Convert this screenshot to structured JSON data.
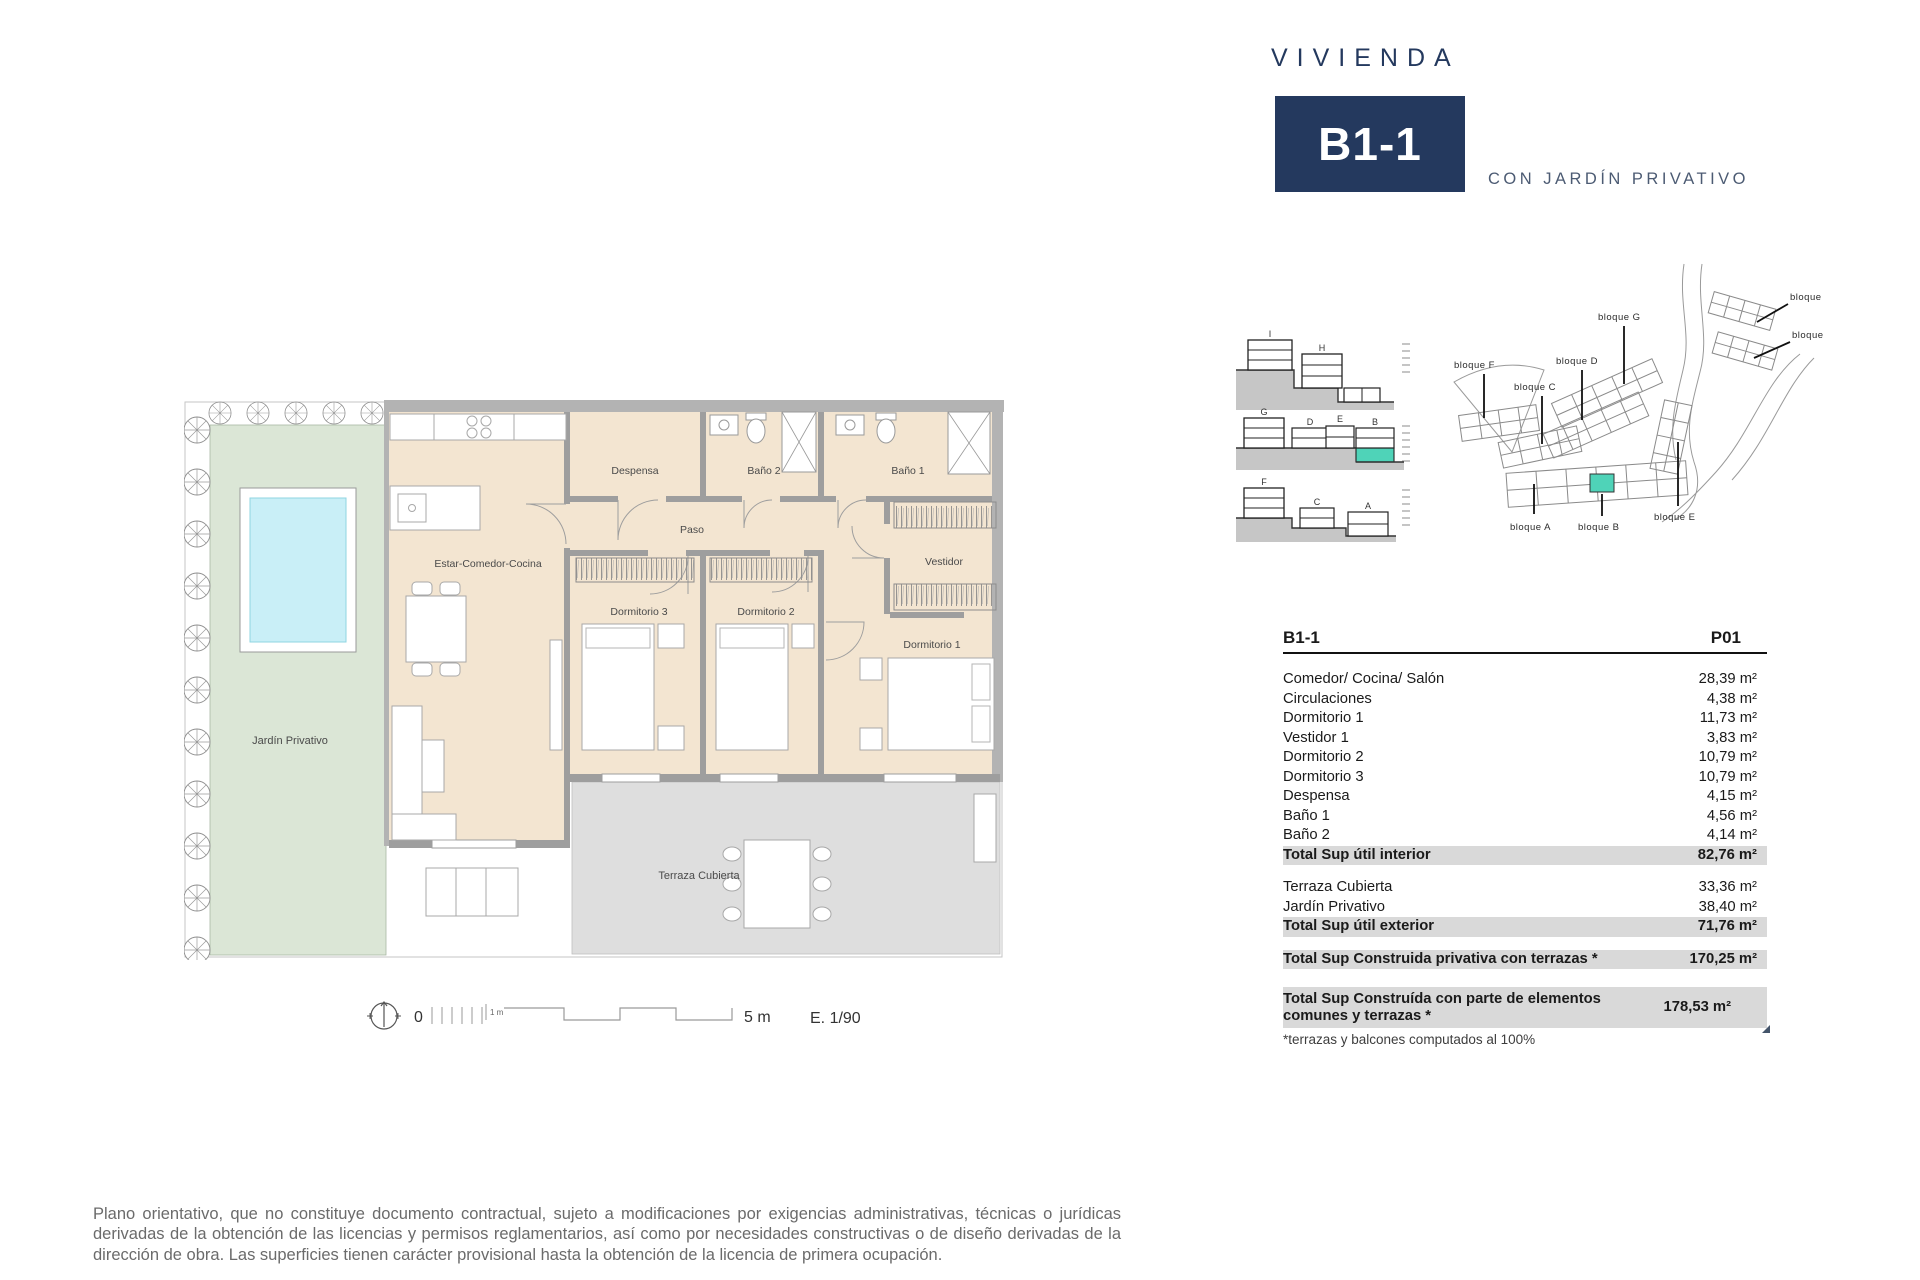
{
  "header": {
    "brand": "VIVIENDA",
    "unit": "B1-1",
    "subtitle": "CON JARDÍN PRIVATIVO"
  },
  "colors": {
    "navy": "#24395e",
    "teal": "#4fd3b8",
    "interior_beige": "#f3e5d1",
    "garden_green": "#dbe6d6",
    "pool_cyan": "#c9eff7",
    "terrace_grey": "#dedede",
    "wall_grey": "#9e9e9e",
    "row_highlight": "#d9d9d9"
  },
  "floorplan": {
    "labels": {
      "living": "Estar-Comedor-Cocina",
      "pantry": "Despensa",
      "bath2": "Baño 2",
      "bath1": "Baño 1",
      "hall": "Paso",
      "bedroom3": "Dormitorio 3",
      "bedroom2": "Dormitorio 2",
      "bedroom1": "Dormitorio 1",
      "dressing": "Vestidor",
      "garden": "Jardín Privativo",
      "terrace": "Terraza Cubierta"
    }
  },
  "scalebar": {
    "zero": "0",
    "one_m": "1 m",
    "five_m": "5 m",
    "scale": "E. 1/90"
  },
  "sections": {
    "row1": [
      "I",
      "H"
    ],
    "row2": [
      "G",
      "D",
      "E",
      "B"
    ],
    "row3": [
      "F",
      "C",
      "A"
    ]
  },
  "siteplan": {
    "blocks": [
      "bloque F",
      "bloque C",
      "bloque D",
      "bloque G",
      "bloque I",
      "bloque H",
      "bloque A",
      "bloque B",
      "bloque E"
    ]
  },
  "table": {
    "col_left": "B1-1",
    "col_right": "P01",
    "rows": [
      {
        "label": "Comedor/ Cocina/ Salón",
        "value": "28,39 m²"
      },
      {
        "label": "Circulaciones",
        "value": "4,38 m²"
      },
      {
        "label": "Dormitorio 1",
        "value": "11,73 m²"
      },
      {
        "label": "Vestidor 1",
        "value": "3,83 m²"
      },
      {
        "label": "Dormitorio 2",
        "value": "10,79 m²"
      },
      {
        "label": "Dormitorio 3",
        "value": "10,79 m²"
      },
      {
        "label": "Despensa",
        "value": "4,15 m²"
      },
      {
        "label": "Baño 1",
        "value": "4,56 m²"
      },
      {
        "label": "Baño 2",
        "value": "4,14 m²"
      },
      {
        "label": "Total Sup útil interior",
        "value": "82,76 m²",
        "total": true
      },
      {
        "spacer": true
      },
      {
        "label": "Terraza Cubierta",
        "value": "33,36 m²"
      },
      {
        "label": "Jardín Privativo",
        "value": "38,40 m²"
      },
      {
        "label": "Total Sup útil exterior",
        "value": "71,76 m²",
        "total": true
      },
      {
        "spacer": true
      },
      {
        "label": "Total Sup Construida privativa con terrazas *",
        "value": "170,25 m²",
        "total": true
      },
      {
        "spacer": true,
        "tallspace": true
      },
      {
        "label": "Total Sup Construída con parte de elementos comunes y terrazas *",
        "value": "178,53 m²",
        "total": true,
        "tall": true,
        "marker": true
      }
    ],
    "footnote": "*terrazas y balcones computados al 100%"
  },
  "disclaimer": "Plano orientativo, que no constituye documento contractual, sujeto a modificaciones por exigencias administrativas, técnicas o jurídicas derivadas de la obtención de las licencias y permisos reglamentarios, así como por necesidades constructivas o de diseño derivadas de la dirección de obra. Las superficies tienen carácter provisional hasta la obtención de la licencia de primera ocupación."
}
